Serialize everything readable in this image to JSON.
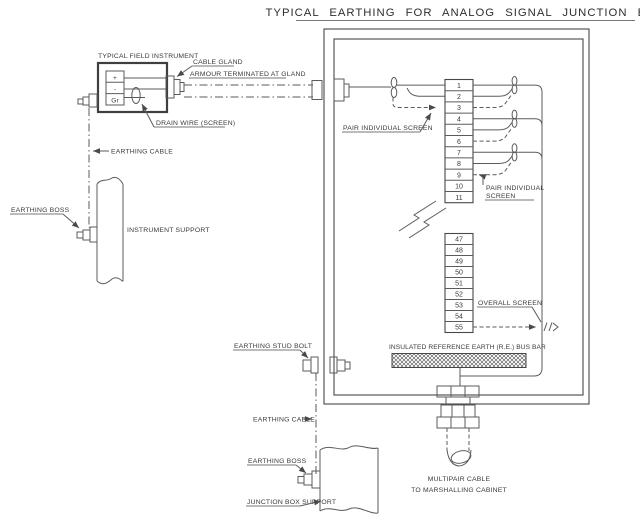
{
  "title": "TYPICAL EARTHING FOR ANALOG SIGNAL JUNCTION BOX",
  "field_instrument": {
    "label": "TYPICAL FIELD INSTRUMENT",
    "terminal_plus": "+",
    "terminal_minus": "-",
    "terminal_ground": "Gr",
    "cable_gland_label": "CABLE GLAND",
    "armour_label": "ARMOUR TERMINATED AT GLAND",
    "drain_wire_label": "DRAIN WIRE (SCREEN)"
  },
  "left_path": {
    "earthing_cable_label": "EARTHING CABLE",
    "earthing_boss_label": "EARTHING BOSS",
    "instrument_support_label": "INSTRUMENT SUPPORT"
  },
  "junction_box": {
    "pair_screen_left_label": "PAIR INDIVIDUAL SCREEN",
    "pair_screen_right_label_line1": "PAIR INDIVIDUAL",
    "pair_screen_right_label_line2": "SCREEN",
    "overall_screen_label": "OVERALL SCREEN",
    "bus_bar_label": "INSULATED REFERENCE EARTH (R.E.) BUS BAR",
    "terminals_upper": [
      "1",
      "2",
      "3",
      "4",
      "5",
      "6",
      "7",
      "8",
      "9",
      "10",
      "11"
    ],
    "terminals_lower": [
      "47",
      "48",
      "49",
      "50",
      "51",
      "52",
      "53",
      "54",
      "55"
    ]
  },
  "bottom": {
    "earthing_stud_bolt_label": "EARTHING STUD BOLT",
    "earthing_cable_label": "EARTHING CABLE",
    "earthing_boss_label": "EARTHING BOSS",
    "junction_box_support_label": "JUNCTION BOX SUPPORT",
    "multipair_cable_label_line1": "MULTIPAIR CABLE",
    "multipair_cable_label_line2": "TO MARSHALLING CABINET"
  },
  "colors": {
    "background": "#ffffff",
    "line": "#5b5b5b",
    "line_dark": "#3f3f3f",
    "text": "#3a3a3a"
  }
}
